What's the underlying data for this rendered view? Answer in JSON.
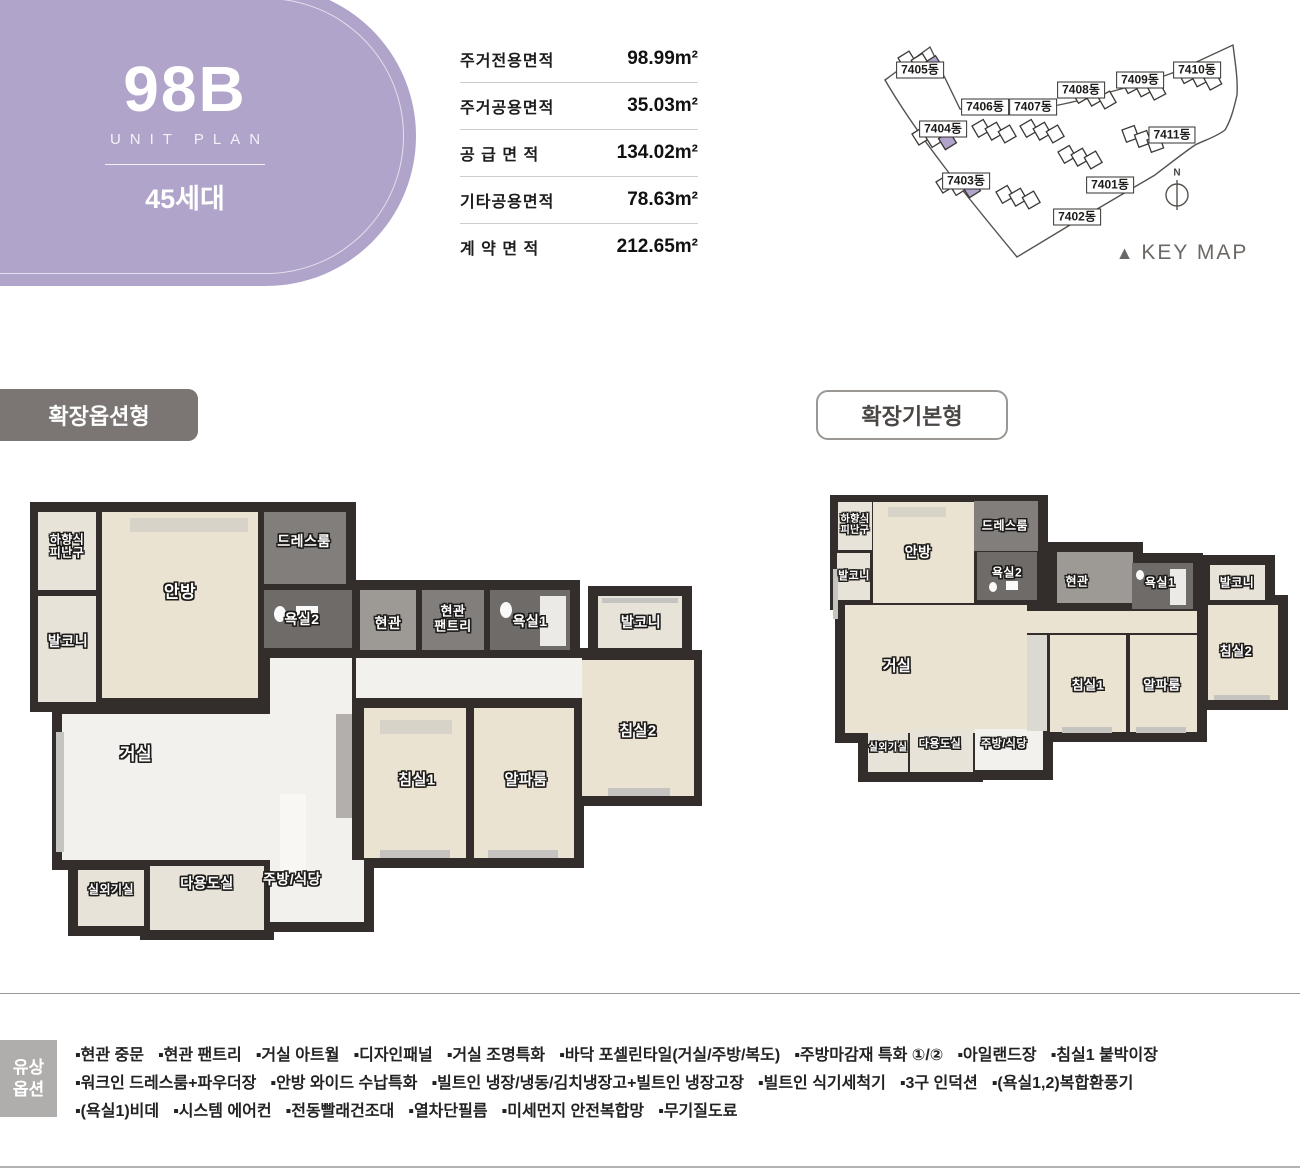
{
  "unit_badge": {
    "code": "98B",
    "subtitle": "UNIT PLAN",
    "households": "45세대"
  },
  "area_table": {
    "rows": [
      {
        "label": "주거전용면적",
        "value": "98.99m²"
      },
      {
        "label": "주거공용면적",
        "value": "35.03m²"
      },
      {
        "label": "공 급 면 적",
        "value": "134.02m²"
      },
      {
        "label": "기타공용면적",
        "value": "78.63m²"
      },
      {
        "label": "계 약 면 적",
        "value": "212.65m²"
      }
    ]
  },
  "keymap": {
    "buildings": [
      "7405동",
      "7406동",
      "7407동",
      "7408동",
      "7409동",
      "7410동",
      "7404동",
      "7411동",
      "7403동",
      "7401동",
      "7402동"
    ],
    "compass": "N",
    "caption_marker": "▲",
    "caption": "KEY MAP"
  },
  "plans": {
    "option": {
      "tag": "확장옵션형",
      "rooms": [
        "하향식\n피난구",
        "발코니",
        "안방",
        "드레스룸",
        "욕실2",
        "현관",
        "현관\n팬트리",
        "욕실1",
        "발코니",
        "침실2",
        "거실",
        "침실1",
        "알파룸",
        "실외기실",
        "다용도실",
        "주방/식당"
      ]
    },
    "basic": {
      "tag": "확장기본형",
      "rooms": [
        "하향식\n피난구",
        "발코니",
        "안방",
        "드레스룸",
        "욕실2",
        "현관",
        "욕실1",
        "발코니",
        "침실2",
        "거실",
        "침실1",
        "알파룸",
        "실외기실",
        "다용도실",
        "주방/식당"
      ]
    }
  },
  "paid_options": {
    "title": [
      "유상",
      "옵션"
    ],
    "bullet": "▪",
    "lines": [
      [
        "현관 중문",
        "현관 팬트리",
        "거실 아트월",
        "디자인패널",
        "거실 조명특화",
        "바닥 포셀린타일(거실/주방/복도)",
        "주방마감재 특화 ①/②",
        "아일랜드장",
        "침실1 붙박이장"
      ],
      [
        "워크인 드레스룸+파우더장",
        "안방 와이드 수납특화",
        "빌트인 냉장/냉동/김치냉장고+빌트인 냉장고장",
        "빌트인 식기세척기",
        "3구 인덕션",
        "(욕실1,2)복합환풍기"
      ],
      [
        "(욕실1)비데",
        "시스템 에어컨",
        "전동빨래건조대",
        "열차단필름",
        "미세먼지 안전복합망",
        "무기질도료"
      ]
    ]
  },
  "colors": {
    "accent_purple": "#b1a4ca",
    "tag_gray": "#7b7573",
    "wall": "#332e2b"
  }
}
